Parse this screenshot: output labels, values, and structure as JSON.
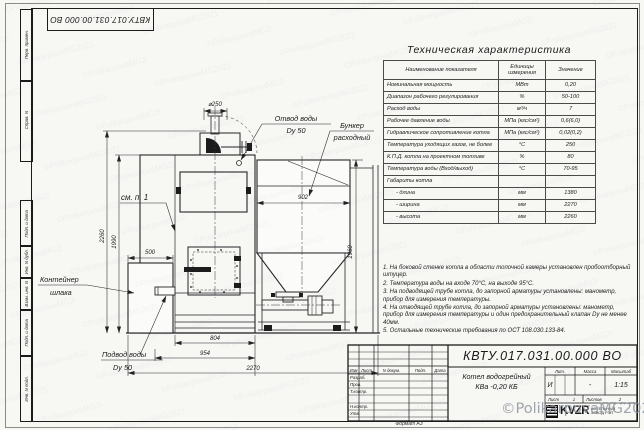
{
  "sheet": {
    "doc_number_top": "КВТУ.017.031.00.000 ВО",
    "format_label": "Формат А3",
    "signature_watermark": "©PolikarpovaMG2021"
  },
  "margin_stamps": {
    "labels": [
      "Перв. примен.",
      "Справ. N",
      "Подп. и дата",
      "Инв. N дубл.",
      "Взам. инв. N",
      "Подп. и дата",
      "Инв. N подл."
    ]
  },
  "spec_table": {
    "title": "Техническая характеристика",
    "headers": [
      "Наименование показателя",
      "Единицы измерения",
      "Значение"
    ],
    "rows": [
      [
        "Номинальная мощность",
        "МВт",
        "0,20"
      ],
      [
        "Диапазон рабочего регулирования",
        "%",
        "50-100"
      ],
      [
        "Расход воды",
        "м³/ч",
        "7"
      ],
      [
        "Рабочее давление воды",
        "МПа (кгс/см²)",
        "0,6(6,0)"
      ],
      [
        "Гидравлическое сопротивление котла",
        "МПа (кгс/см²)",
        "0,02(0,2)"
      ],
      [
        "Температура уходящих газов, не более",
        "°С",
        "250"
      ],
      [
        "К.П.Д. котла на проектном топливе",
        "%",
        "80"
      ],
      [
        "Температура воды (Вход/выход)",
        "°С",
        "70-95"
      ],
      [
        "Габариты котла",
        "",
        ""
      ],
      [
        "- длина",
        "мм",
        "1380"
      ],
      [
        "- ширина",
        "мм",
        "2270"
      ],
      [
        "- высота",
        "мм",
        "2260"
      ]
    ]
  },
  "notes": {
    "items": [
      "1. На боковой стенке котла в области топочной камеры установлен пробоотборный штуцер.",
      "2. Температура воды на входе 70°С, на выходе 95°С.",
      "3. На подводящей трубе котла, до запорной арматуры установлены: манометр, прибор для измерения температуры.",
      "4. На отводящей трубе котла, до запорной арматуры установлены: манометр, прибор для измерения температуры и один предохранительный клапан Dу не менее 40мм.",
      "5. Остальные технические требования по ОСТ 108.030.133-84."
    ]
  },
  "drawing": {
    "labels": {
      "see_note": "см. п. 1",
      "outlet1": "Отвод воды",
      "outlet2": "Dу 50",
      "bunker1": "Бункер",
      "bunker2": "расходный",
      "container1": "Контейнер",
      "container2": "шлака",
      "inlet1": "Подвод воды",
      "inlet2": "Dу 50"
    },
    "dims": {
      "chimney": "⌀250",
      "bunker_width": "902",
      "total_height": "2260",
      "boiler_height": "1990",
      "container_width": "500",
      "base_width": "804",
      "mid_width": "954",
      "total_width": "2270",
      "bunker_height": "1960"
    }
  },
  "title_block": {
    "doc_number": "КВТУ.017.031.00.000 ВО",
    "product_line1": "Котел водогрейный",
    "product_line2": "КВа -0,20 КБ",
    "col_izm": "Изм",
    "col_list": "Лист",
    "col_ndoc": "N докум.",
    "col_podp": "Подп.",
    "col_data": "Дата",
    "row_razrab": "Разраб.",
    "row_prov": "Пров.",
    "row_tkontr": "Т.контр.",
    "row_nkontr": "Н.контр.",
    "row_utv": "Утв.",
    "lit_label": "Лит.",
    "mass_label": "Масса",
    "scale_label": "Масштаб",
    "lit_value": "И",
    "mass_value": "-",
    "scale_value": "1:15",
    "list_label": "Лист",
    "list_value": "1",
    "listov_label": "Листов",
    "listov_value": "2",
    "logo_text": "KVZR",
    "company_line1": "КОТЕЛЬНЫЙ",
    "company_line2": "ЗАВОД РЭП"
  }
}
